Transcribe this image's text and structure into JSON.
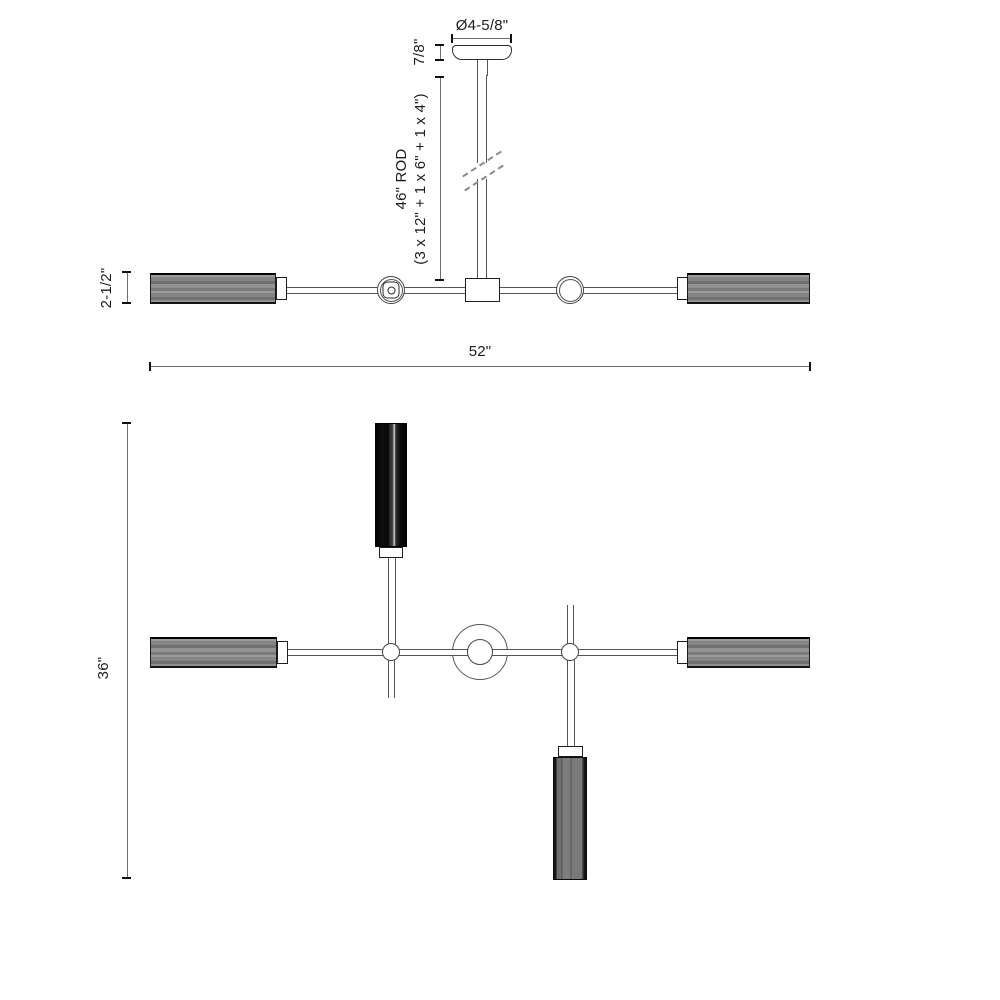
{
  "drawing_type": "light-fixture-dimension-drawing",
  "colors": {
    "background": "#ffffff",
    "outline": "#555555",
    "dimension_line": "#6e6e6e",
    "tick": "#111111",
    "text": "#1c1c1c",
    "shade_gray": "#8a8a8a",
    "shade_dark": "#0d0d0d",
    "shade_mid_gray": "#7a7a7a"
  },
  "elevation": {
    "canopy_diameter_label": "Ø4-5/8\"",
    "canopy_height_label": "7/8\"",
    "rod_label_line1": "46\" ROD",
    "rod_label_line2": "(3 x 12\" + 1 x 6\" + 1 x 4\")",
    "shade_height_label": "2-1/2\"",
    "overall_width_label": "52\""
  },
  "plan": {
    "overall_depth_label": "36\""
  }
}
